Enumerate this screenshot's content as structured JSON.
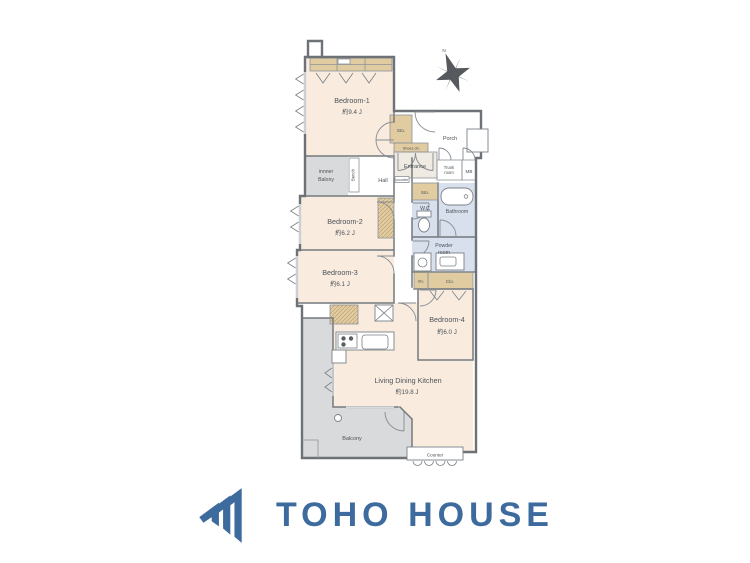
{
  "brand": {
    "name": "TOHO HOUSE",
    "color": "#3d6b9e"
  },
  "compass": {
    "label": "N"
  },
  "colors": {
    "room_fill": "#f9ecdf",
    "closet_fill": "#e1cba1",
    "wet_area_fill": "#d8e0ee",
    "balcony_fill": "#d9dadb",
    "wall": "#6d7277",
    "logo_blue": "#3d6b9e"
  },
  "rooms": {
    "bedroom1": {
      "name": "Bedroom-1",
      "size": "約9.4 J"
    },
    "bedroom2": {
      "name": "Bedroom-2",
      "size": "約6.2 J"
    },
    "bedroom3": {
      "name": "Bedroom-3",
      "size": "約6.1 J"
    },
    "bedroom4": {
      "name": "Bedroom-4",
      "size": "約6.0 J"
    },
    "ldk": {
      "name": "Living Dining Kitchen",
      "size": "約19.8 J"
    },
    "balcony": {
      "name": "Balcony"
    },
    "inner_balcony": {
      "line1": "innner",
      "line2": "Balony"
    },
    "hall": {
      "name": "Hall"
    },
    "bench": {
      "name": "Bench"
    },
    "entrance": {
      "name": "Entrance"
    },
    "entrance_counter": {
      "name": "counter"
    },
    "porch": {
      "name": "Porch"
    },
    "shoes_closet": {
      "name": "Shoes clo"
    },
    "trunk_room": {
      "line1": "Trunk",
      "line2": "room"
    },
    "meter_box": {
      "name": "MB"
    },
    "storage_top": {
      "name": "Sto."
    },
    "storage_mid": {
      "name": "Sto."
    },
    "storage_bottom": {
      "name": "Sto."
    },
    "closet": {
      "name": "Clo."
    },
    "wc": {
      "name": "W.C"
    },
    "bathroom": {
      "name": "Bathroom"
    },
    "powder_room": {
      "line1": "Powder",
      "line2": "room"
    },
    "counter": {
      "name": "Counter"
    }
  }
}
